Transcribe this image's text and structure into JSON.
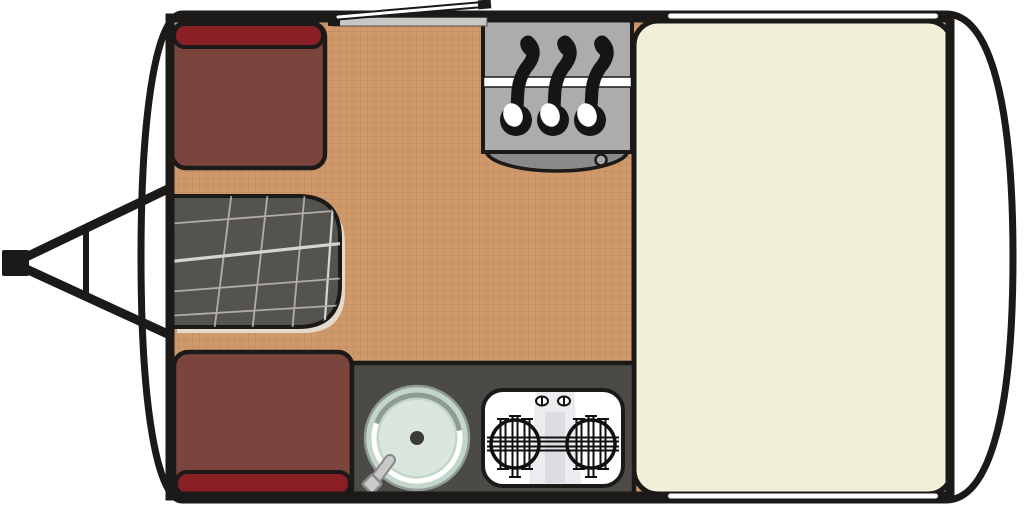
{
  "title": "Caravan floor plan diagram",
  "colors": {
    "outline": "#1c1a18",
    "body_fill": "#ffffff",
    "floor": "#d0996a",
    "floor_grid": "rgba(0,0,0,0.05)",
    "bed": "#f1efd8",
    "seat_cushion": "#7b453d",
    "seat_backrest": "#8a1f26",
    "table": "#555350",
    "table_line": "#cfccc3",
    "table_line_bright": "#ffffff",
    "table_shadow": "#e7e2d8",
    "wardrobe": "#adabac",
    "wardrobe_base": "#8b8a88",
    "wardrobe_knob": "#a9a8a6",
    "rail": "#ffffff",
    "hanger": "#171513",
    "counter": "#4b4a47",
    "sink_outer": "#c3d6cb",
    "sink_inner": "#dbe6dd",
    "sink_ring_dark": "#8f9a94",
    "sink_ring_light": "#ffffff",
    "drain": "#3b3a38",
    "faucet": "#c9c9c9",
    "faucet_edge": "#8a8a88",
    "stove": "#ffffff",
    "stove_detail": "#11100e",
    "stove_shade": "#d9d8e0",
    "window": "#ffffff",
    "threshold": "#c8c7c5"
  },
  "components": {
    "body": {
      "label": "caravan body outline"
    },
    "hitch": {
      "label": "tow hitch A-frame"
    },
    "door": {
      "label": "entry door (open) with threshold"
    },
    "wardrobe": {
      "label": "wardrobe with three clothes hangers on rail"
    },
    "seat_top": {
      "label": "front dinette seat with backrest"
    },
    "seat_bottom": {
      "label": "front dinette seat with backrest"
    },
    "table": {
      "label": "dinette table with plaid cloth"
    },
    "kitchen": {
      "label": "kitchen counter"
    },
    "sink": {
      "label": "round sink with faucet"
    },
    "stove": {
      "label": "two-burner stove with control knobs"
    },
    "bed": {
      "label": "double bed"
    },
    "window_top": {
      "label": "window in top wall"
    },
    "window_bottom": {
      "label": "window in bottom wall"
    }
  }
}
